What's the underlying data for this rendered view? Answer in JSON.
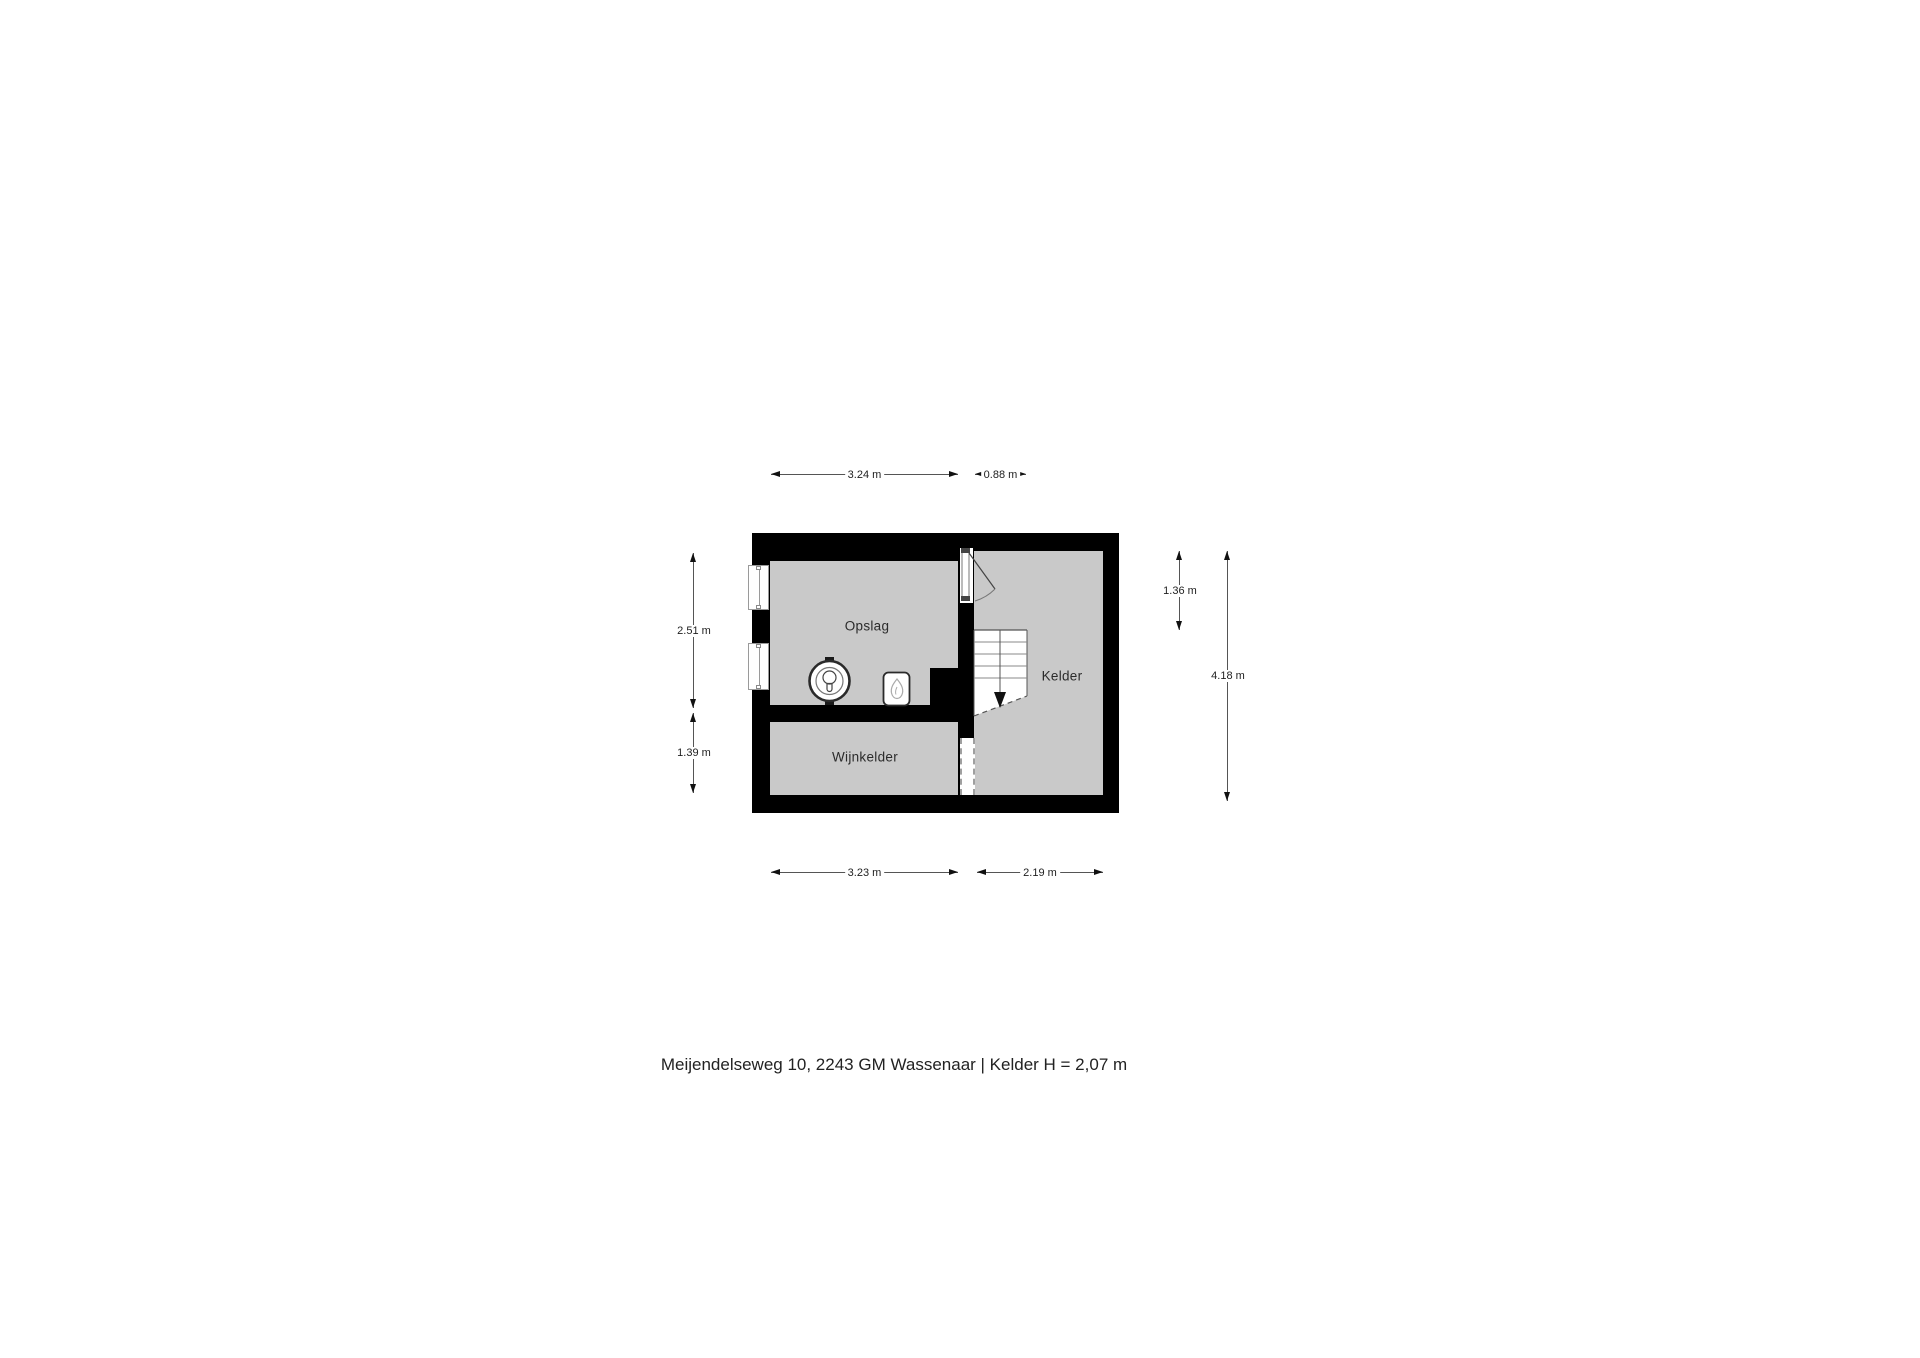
{
  "caption": {
    "text": "Meijendelseweg 10, 2243 GM Wassenaar | Kelder H = 2,07 m"
  },
  "rooms": {
    "opslag": {
      "label": "Opslag"
    },
    "kelder": {
      "label": "Kelder"
    },
    "wijnkelder": {
      "label": "Wijnkelder"
    }
  },
  "dims": {
    "top1": {
      "label": "3.24 m"
    },
    "top2": {
      "label": "0.88 m"
    },
    "bottom1": {
      "label": "3.23 m"
    },
    "bottom2": {
      "label": "2.19 m"
    },
    "left1": {
      "label": "2.51 m"
    },
    "left2": {
      "label": "1.39 m"
    },
    "right1": {
      "label": "1.36 m"
    },
    "right2": {
      "label": "4.18 m"
    }
  },
  "icons": {
    "boiler": "boiler-icon",
    "heater": "cv-ketel-flame-icon",
    "stairs": "staircase-down-icon",
    "door": "door-swing-icon"
  },
  "colors": {
    "wall": "#000000",
    "floor": "#c9c9c9",
    "dimension_line": "#555555",
    "background": "#ffffff"
  }
}
